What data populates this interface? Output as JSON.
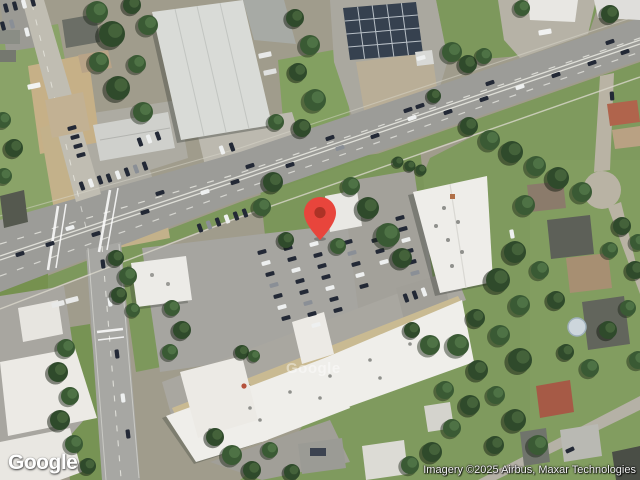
{
  "map": {
    "view_label": "satellite-imagery",
    "marker": {
      "color": "#E8453C",
      "inner_color": "#AD3226"
    },
    "watermark": "Google"
  },
  "footer": {
    "logo": "Google",
    "attribution": "Imagery ©2025 Airbus, Maxar Technologies"
  },
  "palette": {
    "grass": "#7d985c",
    "tree": "#3a5a34",
    "road": "#9c9c98",
    "concrete": "#c0b59a",
    "building_roof": "#edece7"
  }
}
